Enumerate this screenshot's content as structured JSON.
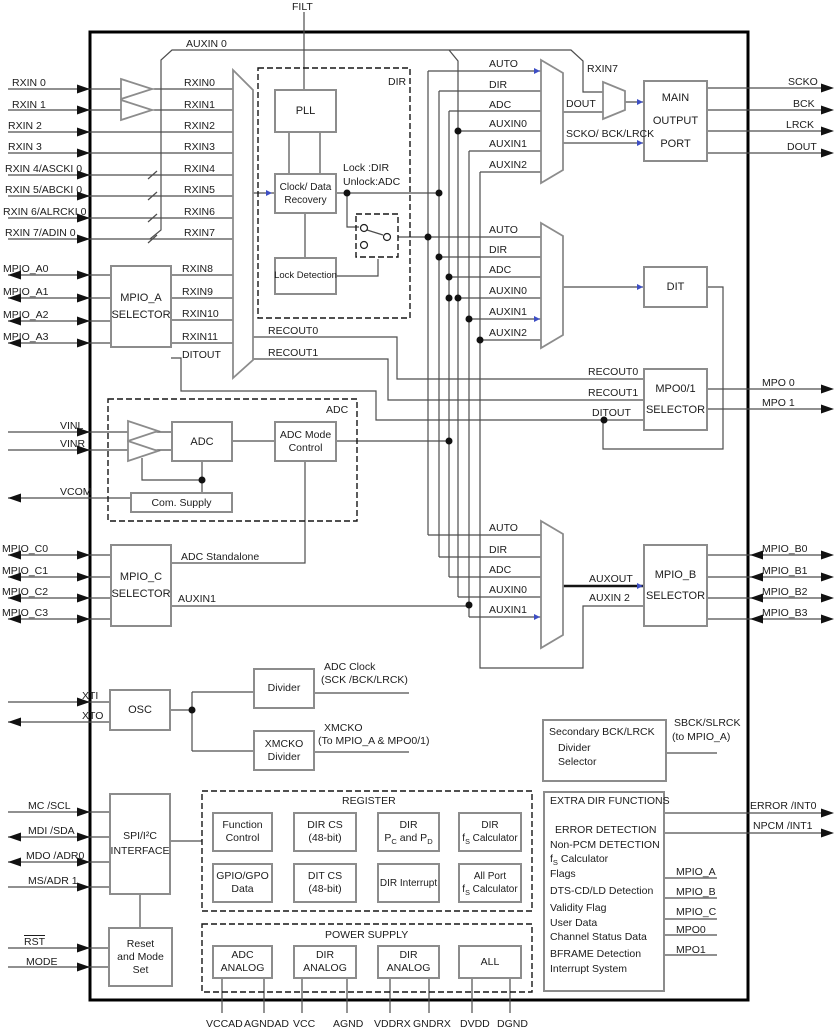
{
  "colors": {
    "wire": "#4d4d4d",
    "box_border": "#8c8c8c",
    "blue_mark": "#3d4ec4",
    "chip_border": "#000000"
  },
  "boxes": [
    {
      "name": "mpio-a-selector-box",
      "x": 110,
      "y": 265,
      "w": 62,
      "h": 83,
      "fs": 11,
      "lh": 17,
      "lines": [
        "MPIO_A",
        "SELECTOR"
      ]
    },
    {
      "name": "pll-box",
      "x": 274,
      "y": 89,
      "w": 63,
      "h": 44,
      "fs": 11,
      "lh": 14,
      "lines": [
        "PLL"
      ]
    },
    {
      "name": "clock-data-recovery-box",
      "x": 274,
      "y": 173,
      "w": 63,
      "h": 41,
      "fs": 10,
      "lh": 13,
      "lines": [
        "Clock/ Data",
        "Recovery"
      ]
    },
    {
      "name": "lock-detection-box",
      "x": 274,
      "y": 257,
      "w": 63,
      "h": 38,
      "fs": 9.5,
      "lh": 12,
      "lines": [
        "Lock Detection"
      ]
    },
    {
      "name": "adc-box",
      "x": 171,
      "y": 421,
      "w": 62,
      "h": 41,
      "fs": 11,
      "lh": 14,
      "lines": [
        "ADC"
      ]
    },
    {
      "name": "adc-mode-control-box",
      "x": 274,
      "y": 421,
      "w": 63,
      "h": 41,
      "fs": 10.5,
      "lh": 13,
      "lines": [
        "ADC Mode",
        "Control"
      ]
    },
    {
      "name": "com-supply-box",
      "x": 130,
      "y": 492,
      "w": 103,
      "h": 21,
      "fs": 10.5,
      "lh": 12,
      "lines": [
        "Com. Supply"
      ]
    },
    {
      "name": "mpio-c-selector-box",
      "x": 110,
      "y": 544,
      "w": 62,
      "h": 83,
      "fs": 11,
      "lh": 17,
      "lines": [
        "MPIO_C",
        "SELECTOR"
      ]
    },
    {
      "name": "osc-box",
      "x": 109,
      "y": 689,
      "w": 62,
      "h": 42,
      "fs": 11,
      "lh": 14,
      "lines": [
        "OSC"
      ]
    },
    {
      "name": "divider-box",
      "x": 253,
      "y": 668,
      "w": 62,
      "h": 41,
      "fs": 10.5,
      "lh": 13,
      "lines": [
        "Divider"
      ]
    },
    {
      "name": "xmcko-divider-box",
      "x": 253,
      "y": 730,
      "w": 62,
      "h": 41,
      "fs": 10.5,
      "lh": 13,
      "lines": [
        "XMCKO",
        "Divider"
      ]
    },
    {
      "name": "spi-i2c-interface-box",
      "x": 109,
      "y": 793,
      "w": 62,
      "h": 102,
      "fs": 10.5,
      "lh": 15,
      "lines": [
        "SPI/I²C",
        "INTERFACE"
      ]
    },
    {
      "name": "reset-mode-set-box",
      "x": 108,
      "y": 927,
      "w": 65,
      "h": 60,
      "fs": 10.5,
      "lh": 13,
      "lines": [
        "Reset",
        "and Mode",
        "Set"
      ]
    },
    {
      "name": "main-output-port-box",
      "x": 643,
      "y": 80,
      "w": 65,
      "h": 82,
      "fs": 11,
      "lh": 23,
      "lines": [
        "MAIN",
        "OUTPUT",
        "PORT"
      ]
    },
    {
      "name": "dit-box",
      "x": 643,
      "y": 266,
      "w": 65,
      "h": 42,
      "fs": 11,
      "lh": 14,
      "lines": [
        "DIT"
      ]
    },
    {
      "name": "mpo01-selector-box",
      "x": 643,
      "y": 368,
      "w": 65,
      "h": 63,
      "fs": 11,
      "lh": 21,
      "lines": [
        "MPO0/1",
        "SELECTOR"
      ]
    },
    {
      "name": "mpio-b-selector-box",
      "x": 643,
      "y": 544,
      "w": 65,
      "h": 83,
      "fs": 11,
      "lh": 21,
      "lines": [
        "MPIO_B",
        "SELECTOR"
      ]
    },
    {
      "name": "secondary-bck-lrck-box",
      "x": 542,
      "y": 719,
      "w": 125,
      "h": 63,
      "fs": 10.5,
      "lh": 14,
      "lines": []
    },
    {
      "name": "extra-dir-functions-box",
      "x": 543,
      "y": 791,
      "w": 122,
      "h": 201,
      "fs": 10.5,
      "lh": 14,
      "lines": []
    },
    {
      "name": "function-control-box",
      "x": 212,
      "y": 812,
      "w": 61,
      "h": 40,
      "fs": 10.5,
      "lh": 13,
      "lines": [
        "Function",
        "Control"
      ]
    },
    {
      "name": "dir-cs-box",
      "x": 293,
      "y": 812,
      "w": 64,
      "h": 40,
      "fs": 10.5,
      "lh": 13,
      "lines": [
        "DIR CS",
        "(48-bit)"
      ]
    },
    {
      "name": "dir-pc-pd-box",
      "x": 377,
      "y": 812,
      "w": 63,
      "h": 40,
      "fs": 10.5,
      "lh": 13,
      "lines": [
        "DIR",
        [
          {
            "t": "P"
          },
          {
            "t": "C",
            "sub": true
          },
          {
            "t": " and P"
          },
          {
            "t": "D",
            "sub": true
          }
        ]
      ]
    },
    {
      "name": "dir-fs-calculator-box",
      "x": 458,
      "y": 812,
      "w": 64,
      "h": 40,
      "fs": 10,
      "lh": 13,
      "lines": [
        "DIR",
        [
          {
            "t": "f"
          },
          {
            "t": "S",
            "sub": true
          },
          {
            "t": " Calculator"
          }
        ]
      ]
    },
    {
      "name": "gpio-gpo-data-box",
      "x": 212,
      "y": 863,
      "w": 61,
      "h": 40,
      "fs": 10.5,
      "lh": 13,
      "lines": [
        "GPIO/GPO",
        "Data"
      ]
    },
    {
      "name": "dit-cs-box",
      "x": 293,
      "y": 863,
      "w": 64,
      "h": 40,
      "fs": 10.5,
      "lh": 13,
      "lines": [
        "DIT CS",
        "(48-bit)"
      ]
    },
    {
      "name": "dir-interrupt-box",
      "x": 377,
      "y": 863,
      "w": 63,
      "h": 40,
      "fs": 10,
      "lh": 13,
      "lines": [
        "DIR Interrupt"
      ]
    },
    {
      "name": "all-port-fs-calculator-box",
      "x": 458,
      "y": 863,
      "w": 64,
      "h": 40,
      "fs": 10,
      "lh": 13,
      "lines": [
        "All Port",
        [
          {
            "t": "f"
          },
          {
            "t": "S",
            "sub": true
          },
          {
            "t": " Calculator"
          }
        ]
      ]
    },
    {
      "name": "adc-analog-box",
      "x": 212,
      "y": 945,
      "w": 61,
      "h": 34,
      "fs": 10.5,
      "lh": 13,
      "lines": [
        "ADC",
        "ANALOG"
      ]
    },
    {
      "name": "dir-analog-box-1",
      "x": 293,
      "y": 945,
      "w": 64,
      "h": 34,
      "fs": 10.5,
      "lh": 13,
      "lines": [
        "DIR",
        "ANALOG"
      ]
    },
    {
      "name": "dir-analog-box-2",
      "x": 377,
      "y": 945,
      "w": 63,
      "h": 34,
      "fs": 10.5,
      "lh": 13,
      "lines": [
        "DIR",
        "ANALOG"
      ]
    },
    {
      "name": "all-supply-box",
      "x": 458,
      "y": 945,
      "w": 64,
      "h": 34,
      "fs": 10.5,
      "lh": 13,
      "lines": [
        "ALL"
      ]
    }
  ],
  "labels": [
    {
      "name": "pin-filt",
      "text": "FILT",
      "x": 292,
      "y": 1
    },
    {
      "name": "pin-rxin0",
      "text": "RXIN 0",
      "x": 12,
      "y": 77
    },
    {
      "name": "pin-rxin1",
      "text": "RXIN 1",
      "x": 12,
      "y": 99
    },
    {
      "name": "pin-rxin2",
      "text": "RXIN 2",
      "x": 8,
      "y": 120
    },
    {
      "name": "pin-rxin3",
      "text": "RXIN 3",
      "x": 8,
      "y": 141
    },
    {
      "name": "pin-rxin4",
      "text": "RXIN 4/ASCKI 0",
      "x": 5,
      "y": 163
    },
    {
      "name": "pin-rxin5",
      "text": "RXIN 5/ABCKI 0",
      "x": 5,
      "y": 184
    },
    {
      "name": "pin-rxin6",
      "text": "RXIN 6/ALRCKI 0",
      "x": 3,
      "y": 206
    },
    {
      "name": "pin-rxin7",
      "text": "RXIN 7/ADIN 0",
      "x": 5,
      "y": 227
    },
    {
      "name": "pin-mpio-a0",
      "text": "MPIO_A0",
      "x": 3,
      "y": 263
    },
    {
      "name": "pin-mpio-a1",
      "text": "MPIO_A1",
      "x": 3,
      "y": 286
    },
    {
      "name": "pin-mpio-a2",
      "text": "MPIO_A2",
      "x": 3,
      "y": 309
    },
    {
      "name": "pin-mpio-a3",
      "text": "MPIO_A3",
      "x": 3,
      "y": 331
    },
    {
      "name": "pin-vinl",
      "text": "VINL",
      "x": 60,
      "y": 420
    },
    {
      "name": "pin-vinr",
      "text": "VINR",
      "x": 60,
      "y": 438
    },
    {
      "name": "pin-vcom",
      "text": "VCOM",
      "x": 60,
      "y": 486
    },
    {
      "name": "pin-mpio-c0",
      "text": "MPIO_C0",
      "x": 2,
      "y": 543
    },
    {
      "name": "pin-mpio-c1",
      "text": "MPIO_C1",
      "x": 2,
      "y": 565
    },
    {
      "name": "pin-mpio-c2",
      "text": "MPIO_C2",
      "x": 2,
      "y": 586
    },
    {
      "name": "pin-mpio-c3",
      "text": "MPIO_C3",
      "x": 2,
      "y": 607
    },
    {
      "name": "pin-xti",
      "text": "XTI",
      "x": 82,
      "y": 690
    },
    {
      "name": "pin-xto",
      "text": "XTO",
      "x": 82,
      "y": 710
    },
    {
      "name": "pin-mc-scl",
      "text": "MC /SCL",
      "x": 28,
      "y": 800
    },
    {
      "name": "pin-mdi-sda",
      "text": "MDI /SDA",
      "x": 28,
      "y": 825
    },
    {
      "name": "pin-mdo-adr0",
      "text": "MDO /ADR0",
      "x": 26,
      "y": 850
    },
    {
      "name": "pin-ms-adr1",
      "text": "MS/ADR 1",
      "x": 28,
      "y": 875
    },
    {
      "name": "pin-rst",
      "text": "RST",
      "x": 24,
      "y": 936,
      "cls": "overline"
    },
    {
      "name": "pin-mode",
      "text": "MODE",
      "x": 26,
      "y": 956
    },
    {
      "name": "sig-rxin0",
      "text": "RXIN0",
      "x": 184,
      "y": 77
    },
    {
      "name": "sig-rxin1",
      "text": "RXIN1",
      "x": 184,
      "y": 99
    },
    {
      "name": "sig-rxin2",
      "text": "RXIN2",
      "x": 184,
      "y": 120
    },
    {
      "name": "sig-rxin3",
      "text": "RXIN3",
      "x": 184,
      "y": 141
    },
    {
      "name": "sig-rxin4",
      "text": "RXIN4",
      "x": 184,
      "y": 163
    },
    {
      "name": "sig-rxin5",
      "text": "RXIN5",
      "x": 184,
      "y": 184
    },
    {
      "name": "sig-rxin6",
      "text": "RXIN6",
      "x": 184,
      "y": 206
    },
    {
      "name": "sig-rxin7",
      "text": "RXIN7",
      "x": 184,
      "y": 227
    },
    {
      "name": "sig-rxin8",
      "text": "RXIN8",
      "x": 182,
      "y": 263
    },
    {
      "name": "sig-rxin9",
      "text": "RXIN9",
      "x": 182,
      "y": 286
    },
    {
      "name": "sig-rxin10",
      "text": "RXIN10",
      "x": 182,
      "y": 308
    },
    {
      "name": "sig-rxin11",
      "text": "RXIN11",
      "x": 182,
      "y": 331
    },
    {
      "name": "sig-ditout-left",
      "text": "DITOUT",
      "x": 182,
      "y": 349
    },
    {
      "name": "sig-auxin0-top",
      "text": "AUXIN 0",
      "x": 186,
      "y": 38
    },
    {
      "name": "sig-recout0-left",
      "text": "RECOUT0",
      "x": 268,
      "y": 325
    },
    {
      "name": "sig-recout1-left",
      "text": "RECOUT1",
      "x": 268,
      "y": 347
    },
    {
      "name": "tag-dir",
      "text": "DIR",
      "x": 388,
      "y": 76
    },
    {
      "name": "note-lock-dir",
      "text": "Lock :DIR",
      "x": 343,
      "y": 162
    },
    {
      "name": "note-unlock-adc",
      "text": "Unlock:ADC",
      "x": 343,
      "y": 176
    },
    {
      "name": "tag-adc",
      "text": "ADC",
      "x": 326,
      "y": 404
    },
    {
      "name": "sig-adc-standalone",
      "text": "ADC Standalone",
      "x": 181,
      "y": 551
    },
    {
      "name": "sig-auxin1-out",
      "text": "AUXIN1",
      "x": 178,
      "y": 593
    },
    {
      "name": "sig-adc-clock-1",
      "text": "ADC Clock",
      "x": 324,
      "y": 661
    },
    {
      "name": "sig-adc-clock-2",
      "text": "(SCK /BCK/LRCK)",
      "x": 321,
      "y": 674
    },
    {
      "name": "sig-xmcko-1",
      "text": "XMCKO",
      "x": 324,
      "y": 722
    },
    {
      "name": "sig-xmcko-2",
      "text": "(To MPIO_A & MPO0/1)",
      "x": 318,
      "y": 735
    },
    {
      "name": "sig-sbck-1",
      "text": "SBCK/SLRCK",
      "x": 674,
      "y": 717
    },
    {
      "name": "sig-sbck-2",
      "text": "(to MPIO_A)",
      "x": 672,
      "y": 731
    },
    {
      "name": "title-register",
      "text": "REGISTER",
      "x": 342,
      "y": 795
    },
    {
      "name": "title-power-supply",
      "text": "POWER SUPPLY",
      "x": 325,
      "y": 929
    },
    {
      "name": "mux1-auto",
      "text": "AUTO",
      "x": 489,
      "y": 58
    },
    {
      "name": "mux1-dir",
      "text": "DIR",
      "x": 489,
      "y": 79
    },
    {
      "name": "mux1-adc",
      "text": "ADC",
      "x": 489,
      "y": 99
    },
    {
      "name": "mux1-auxin0",
      "text": "AUXIN0",
      "x": 489,
      "y": 118
    },
    {
      "name": "mux1-auxin1",
      "text": "AUXIN1",
      "x": 489,
      "y": 138
    },
    {
      "name": "mux1-auxin2",
      "text": "AUXIN2",
      "x": 489,
      "y": 159
    },
    {
      "name": "mux2-auto",
      "text": "AUTO",
      "x": 489,
      "y": 224
    },
    {
      "name": "mux2-dir",
      "text": "DIR",
      "x": 489,
      "y": 244
    },
    {
      "name": "mux2-adc",
      "text": "ADC",
      "x": 489,
      "y": 264
    },
    {
      "name": "mux2-auxin0",
      "text": "AUXIN0",
      "x": 489,
      "y": 285
    },
    {
      "name": "mux2-auxin1",
      "text": "AUXIN1",
      "x": 489,
      "y": 306
    },
    {
      "name": "mux2-auxin2",
      "text": "AUXIN2",
      "x": 489,
      "y": 327
    },
    {
      "name": "mux3-auto",
      "text": "AUTO",
      "x": 489,
      "y": 522
    },
    {
      "name": "mux3-dir",
      "text": "DIR",
      "x": 489,
      "y": 544
    },
    {
      "name": "mux3-adc",
      "text": "ADC",
      "x": 489,
      "y": 564
    },
    {
      "name": "mux3-auxin0",
      "text": "AUXIN0",
      "x": 489,
      "y": 584
    },
    {
      "name": "mux3-auxin1",
      "text": "AUXIN1",
      "x": 489,
      "y": 604
    },
    {
      "name": "sig-rxin7-bypass",
      "text": "RXIN7",
      "x": 587,
      "y": 63
    },
    {
      "name": "sig-dout",
      "text": "DOUT",
      "x": 566,
      "y": 98
    },
    {
      "name": "sig-scko-bck-lrck",
      "text": "SCKO/ BCK/LRCK",
      "x": 566,
      "y": 128
    },
    {
      "name": "sig-recout0-right",
      "text": "RECOUT0",
      "x": 588,
      "y": 366
    },
    {
      "name": "sig-recout1-right",
      "text": "RECOUT1",
      "x": 588,
      "y": 387
    },
    {
      "name": "sig-ditout-right",
      "text": "DITOUT",
      "x": 592,
      "y": 407
    },
    {
      "name": "sig-auxout",
      "text": "AUXOUT",
      "x": 589,
      "y": 573
    },
    {
      "name": "sig-auxin2-right",
      "text": "AUXIN 2",
      "x": 589,
      "y": 592
    },
    {
      "name": "sec-line-1",
      "text": "Secondary BCK/LRCK",
      "x": 549,
      "y": 726
    },
    {
      "name": "sec-line-2",
      "text": "Divider",
      "x": 558,
      "y": 742
    },
    {
      "name": "sec-line-3",
      "text": "Selector",
      "x": 558,
      "y": 756
    },
    {
      "name": "extra-title",
      "text": "EXTRA DIR FUNCTIONS",
      "x": 550,
      "y": 795
    },
    {
      "name": "extra-item-error-detection",
      "text": "ERROR DETECTION",
      "x": 555,
      "y": 824
    },
    {
      "name": "extra-item-non-pcm",
      "text": "Non-PCM DETECTION",
      "x": 550,
      "y": 839
    },
    {
      "name": "extra-item-fs-calculator",
      "parts": [
        {
          "t": "f"
        },
        {
          "t": "S",
          "sub": true
        },
        {
          "t": " Calculator"
        }
      ],
      "x": 550,
      "y": 853
    },
    {
      "name": "extra-item-flags",
      "text": "Flags",
      "x": 550,
      "y": 868
    },
    {
      "name": "extra-item-dts",
      "text": "DTS-CD/LD Detection",
      "x": 550,
      "y": 885
    },
    {
      "name": "extra-item-validity",
      "text": "Validity Flag",
      "x": 550,
      "y": 902
    },
    {
      "name": "extra-item-user-data",
      "text": "User Data",
      "x": 550,
      "y": 917
    },
    {
      "name": "extra-item-channel-status",
      "text": "Channel Status Data",
      "x": 550,
      "y": 931
    },
    {
      "name": "extra-item-bframe",
      "text": "BFRAME Detection",
      "x": 550,
      "y": 948
    },
    {
      "name": "extra-item-interrupt",
      "text": "Interrupt System",
      "x": 550,
      "y": 963
    },
    {
      "name": "stub-mpio-a",
      "text": "MPIO_A",
      "x": 676,
      "y": 866
    },
    {
      "name": "stub-mpio-b",
      "text": "MPIO_B",
      "x": 676,
      "y": 886
    },
    {
      "name": "stub-mpio-c",
      "text": "MPIO_C",
      "x": 676,
      "y": 906
    },
    {
      "name": "stub-mpo0",
      "text": "MPO0",
      "x": 676,
      "y": 924
    },
    {
      "name": "stub-mpo1",
      "text": "MPO1",
      "x": 676,
      "y": 944
    },
    {
      "name": "pin-scko",
      "text": "SCKO",
      "x": 788,
      "y": 76
    },
    {
      "name": "pin-bck",
      "text": "BCK",
      "x": 793,
      "y": 98
    },
    {
      "name": "pin-lrck",
      "text": "LRCK",
      "x": 786,
      "y": 119
    },
    {
      "name": "pin-dout",
      "text": "DOUT",
      "x": 787,
      "y": 141
    },
    {
      "name": "pin-mpo0",
      "text": "MPO 0",
      "x": 762,
      "y": 377
    },
    {
      "name": "pin-mpo1",
      "text": "MPO 1",
      "x": 762,
      "y": 397
    },
    {
      "name": "pin-mpio-b0",
      "text": "MPIO_B0",
      "x": 762,
      "y": 543
    },
    {
      "name": "pin-mpio-b1",
      "text": "MPIO_B1",
      "x": 762,
      "y": 565
    },
    {
      "name": "pin-mpio-b2",
      "text": "MPIO_B2",
      "x": 762,
      "y": 586
    },
    {
      "name": "pin-mpio-b3",
      "text": "MPIO_B3",
      "x": 762,
      "y": 607
    },
    {
      "name": "pin-error-int0",
      "text": "ERROR /INT0",
      "x": 750,
      "y": 800
    },
    {
      "name": "pin-npcm-int1",
      "text": "NPCM /INT1",
      "x": 753,
      "y": 820
    },
    {
      "name": "pin-vccad",
      "text": "VCCAD",
      "x": 206,
      "y": 1018
    },
    {
      "name": "pin-agndad",
      "text": "AGNDAD",
      "x": 244,
      "y": 1018
    },
    {
      "name": "pin-vcc",
      "text": "VCC",
      "x": 293,
      "y": 1018
    },
    {
      "name": "pin-agnd",
      "text": "AGND",
      "x": 333,
      "y": 1018
    },
    {
      "name": "pin-vddrx",
      "text": "VDDRX",
      "x": 374,
      "y": 1018
    },
    {
      "name": "pin-gndrx",
      "text": "GNDRX",
      "x": 413,
      "y": 1018
    },
    {
      "name": "pin-dvdd",
      "text": "DVDD",
      "x": 460,
      "y": 1018
    },
    {
      "name": "pin-dgnd",
      "text": "DGND",
      "x": 497,
      "y": 1018
    }
  ]
}
